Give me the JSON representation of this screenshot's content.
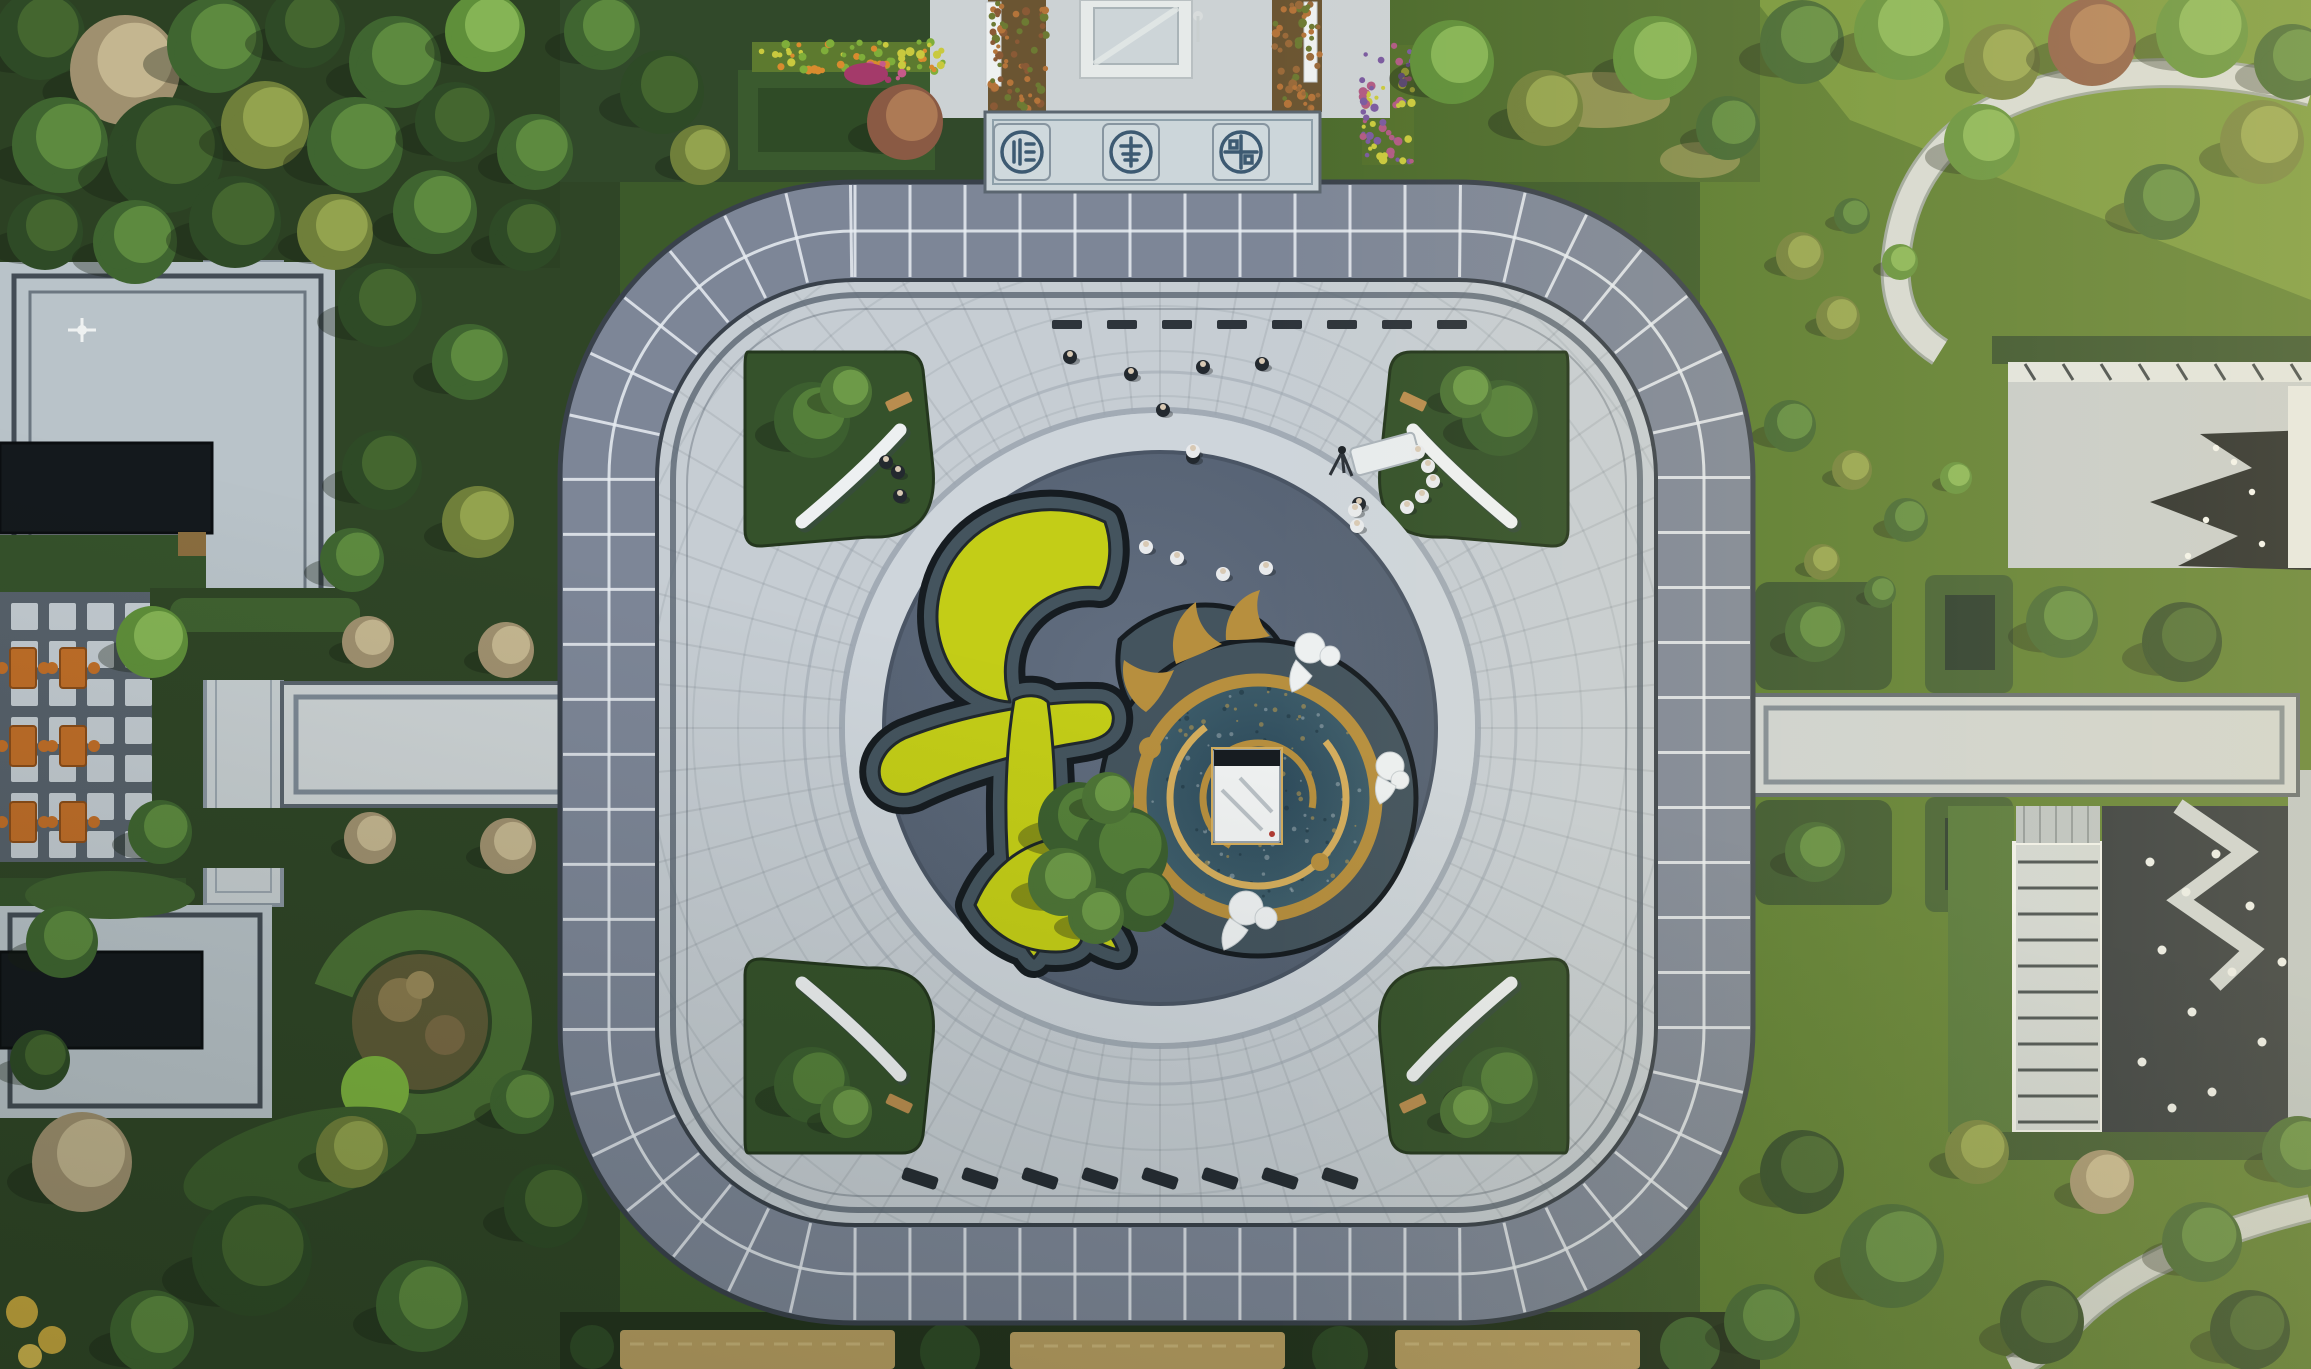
{
  "meta": {
    "title": "Aerial drone view of a landscaped residential plaza",
    "description": "Top-down aerial photograph of a square plaza ringed by a slate-tiled walkway with rounded corners. The center holds a dark circular court containing a giant chartreuse topiary of the Chinese character for harmony beside a gold-and-blue dragon-swirl water mosaic with a white stone plinth. Gardens, reflecting pools, a checkerboard terrace with orange tables, and modern courtyard buildings surround the plaza."
  },
  "palette": {
    "grass-dark": "#2f4526",
    "grass-mid": "#3c5a2a",
    "grass-bright": "#577a2e",
    "band": "#7d8697",
    "band-edge": "#39414b",
    "grout": "#e8edf2",
    "plaza": "#c6cdd3",
    "plaza-line": "#5a6572",
    "arc": "#99a3ae",
    "center-dark": "#5b6678",
    "center-rim": "#4a5565",
    "halo": "#ced5db",
    "bed-stone": "#44545e",
    "bed-dark": "#161c21",
    "chartreuse": "#c3cd17",
    "gold": "#b78f3e",
    "gold-light": "#d4ad5d",
    "mosaic1": "#2b4859",
    "mosaic2": "#4a6b75",
    "white": "#edf0f1",
    "path": "#ccd2d4",
    "path-edge": "#7c8894",
    "roof": "#b9c3c9",
    "roof-line": "#434c55",
    "pool": "#14191d",
    "hedge": "#35522b",
    "hedge-bright": "#4a7034",
    "orange": "#c06e28",
    "orange-dark": "#8a4c18",
    "cobble": "#262e38",
    "tan": "#b99f62",
    "shadow": "rgba(22,32,20,0.35)",
    "emblem": "#cfd9dd",
    "emblem-ink": "#3d5a72"
  },
  "tree_palette": {
    "deep": [
      "#2e4a26",
      "#44662f"
    ],
    "green": [
      "#3f6530",
      "#5d8a3f"
    ],
    "bright": [
      "#5f8f3a",
      "#85b455"
    ],
    "olive": [
      "#6f7f3a",
      "#93a34e"
    ],
    "rust": [
      "#8a5a44",
      "#ad7a55"
    ],
    "bare": [
      "#9f906f",
      "#c4b690"
    ],
    "pine": [
      "#3c5f2f",
      "#55803a"
    ],
    "pinehi": [
      "#4d7436",
      "#6d9a48"
    ]
  },
  "scene": {
    "emblems": [
      {
        "name": "fu-blessing-seal"
      },
      {
        "name": "shou-longevity-seal"
      },
      {
        "name": "lu-prosperity-seal"
      }
    ],
    "ring": {
      "tile_spacing": 55,
      "half_width": 46
    },
    "spokes": {
      "count": 72,
      "r1": 318,
      "r2": 668
    },
    "faint_rings": {
      "start": 332,
      "step": 45,
      "count": 8
    },
    "mosaic_speckles": {
      "cx": 1258,
      "cy": 798,
      "r": 112,
      "count": 130
    },
    "bench_row": {
      "x0": 1052,
      "y": 320,
      "step": 55,
      "count": 8,
      "w": 30,
      "h": 9
    },
    "loungers": {
      "x0": 902,
      "y": 1172,
      "step": 60,
      "count": 8,
      "w": 36,
      "h": 13,
      "angle": 18
    },
    "glass_lines": {
      "x1": 2018,
      "x2": 2098,
      "y0": 862,
      "step": 26,
      "count": 11
    },
    "roof_ticks": {
      "x0": 2025,
      "step": 38,
      "count": 8,
      "y1": 364,
      "y2": 380
    },
    "trees": [
      [
        40,
        35,
        45,
        "deep"
      ],
      [
        125,
        70,
        55,
        "bare"
      ],
      [
        215,
        45,
        48,
        "green"
      ],
      [
        305,
        28,
        40,
        "deep"
      ],
      [
        395,
        62,
        46,
        "green"
      ],
      [
        485,
        32,
        40,
        "bright"
      ],
      [
        60,
        145,
        48,
        "green"
      ],
      [
        165,
        155,
        58,
        "deep"
      ],
      [
        265,
        125,
        44,
        "olive"
      ],
      [
        355,
        145,
        48,
        "green"
      ],
      [
        455,
        122,
        40,
        "deep"
      ],
      [
        535,
        152,
        38,
        "green"
      ],
      [
        45,
        232,
        38,
        "deep"
      ],
      [
        135,
        242,
        42,
        "green"
      ],
      [
        235,
        222,
        46,
        "deep"
      ],
      [
        335,
        232,
        38,
        "olive"
      ],
      [
        435,
        212,
        42,
        "green"
      ],
      [
        525,
        235,
        36,
        "deep"
      ],
      [
        380,
        305,
        42,
        "deep"
      ],
      [
        470,
        362,
        38,
        "green"
      ],
      [
        382,
        470,
        40,
        "deep"
      ],
      [
        478,
        522,
        36,
        "olive"
      ],
      [
        352,
        560,
        32,
        "green"
      ],
      [
        152,
        642,
        36,
        "bright"
      ],
      [
        160,
        832,
        32,
        "green"
      ],
      [
        368,
        642,
        26,
        "bare"
      ],
      [
        506,
        650,
        28,
        "bare"
      ],
      [
        370,
        838,
        26,
        "bare"
      ],
      [
        508,
        846,
        28,
        "bare"
      ],
      [
        82,
        1162,
        50,
        "bare"
      ],
      [
        252,
        1256,
        60,
        "deep"
      ],
      [
        422,
        1306,
        46,
        "green"
      ],
      [
        546,
        1206,
        42,
        "deep"
      ],
      [
        152,
        1332,
        42,
        "green"
      ],
      [
        352,
        1152,
        36,
        "olive"
      ],
      [
        522,
        1102,
        32,
        "green"
      ],
      [
        62,
        942,
        36,
        "green"
      ],
      [
        40,
        1060,
        30,
        "deep"
      ],
      [
        602,
        32,
        38,
        "green"
      ],
      [
        662,
        92,
        42,
        "deep"
      ],
      [
        905,
        122,
        38,
        "rust"
      ],
      [
        700,
        155,
        30,
        "olive"
      ],
      [
        1452,
        62,
        42,
        "bright"
      ],
      [
        1545,
        108,
        38,
        "olive"
      ],
      [
        1655,
        58,
        42,
        "bright"
      ],
      [
        1728,
        128,
        32,
        "green"
      ],
      [
        1802,
        42,
        42,
        "green"
      ],
      [
        1902,
        32,
        48,
        "bright"
      ],
      [
        2002,
        62,
        38,
        "olive"
      ],
      [
        2092,
        42,
        44,
        "rust"
      ],
      [
        2202,
        32,
        46,
        "bright"
      ],
      [
        2292,
        62,
        38,
        "green"
      ],
      [
        1982,
        142,
        38,
        "bright"
      ],
      [
        2262,
        142,
        42,
        "olive"
      ],
      [
        2162,
        202,
        38,
        "green"
      ],
      [
        1800,
        256,
        24,
        "olive"
      ],
      [
        1852,
        216,
        18,
        "green"
      ],
      [
        1900,
        262,
        18,
        "bright"
      ],
      [
        1838,
        318,
        22,
        "olive"
      ],
      [
        1790,
        426,
        26,
        "green"
      ],
      [
        1852,
        470,
        20,
        "olive"
      ],
      [
        1906,
        520,
        22,
        "green"
      ],
      [
        1956,
        478,
        16,
        "bright"
      ],
      [
        1822,
        562,
        18,
        "olive"
      ],
      [
        1880,
        592,
        16,
        "green"
      ],
      [
        2062,
        622,
        36,
        "green"
      ],
      [
        2182,
        642,
        40,
        "deep"
      ],
      [
        1815,
        632,
        30,
        "green"
      ],
      [
        1815,
        852,
        30,
        "green"
      ],
      [
        1802,
        1172,
        42,
        "deep"
      ],
      [
        1892,
        1256,
        52,
        "green"
      ],
      [
        2042,
        1322,
        42,
        "deep"
      ],
      [
        2202,
        1242,
        40,
        "green"
      ],
      [
        1977,
        1152,
        32,
        "olive"
      ],
      [
        2298,
        1152,
        36,
        "green"
      ],
      [
        2102,
        1182,
        32,
        "bare"
      ],
      [
        1762,
        1322,
        38,
        "green"
      ],
      [
        2250,
        1330,
        40,
        "deep"
      ]
    ],
    "plaza_trees": [
      [
        812,
        420,
        38,
        "pine"
      ],
      [
        846,
        392,
        26,
        "pinehi"
      ],
      [
        1500,
        418,
        38,
        "pine"
      ],
      [
        1466,
        392,
        26,
        "pinehi"
      ],
      [
        812,
        1085,
        38,
        "pine"
      ],
      [
        846,
        1112,
        26,
        "pinehi"
      ],
      [
        1500,
        1085,
        38,
        "pine"
      ],
      [
        1466,
        1112,
        26,
        "pinehi"
      ],
      [
        1078,
        822,
        40,
        "pine"
      ],
      [
        1122,
        852,
        46,
        "pine"
      ],
      [
        1062,
        882,
        34,
        "pinehi"
      ],
      [
        1142,
        900,
        32,
        "pine"
      ],
      [
        1096,
        916,
        28,
        "pinehi"
      ],
      [
        1108,
        798,
        26,
        "pinehi"
      ]
    ],
    "people": [
      [
        1070,
        357,
        "dark"
      ],
      [
        1131,
        374,
        "dark"
      ],
      [
        1203,
        367,
        "dark"
      ],
      [
        1262,
        364,
        "dark"
      ],
      [
        1163,
        410,
        "dark"
      ],
      [
        1193,
        457,
        "dark"
      ],
      [
        898,
        472,
        "dark"
      ],
      [
        900,
        496,
        "dark"
      ],
      [
        886,
        462,
        "dark"
      ],
      [
        1359,
        504,
        "dark"
      ],
      [
        1146,
        547,
        "light"
      ],
      [
        1177,
        558,
        "light"
      ],
      [
        1223,
        574,
        "light"
      ],
      [
        1266,
        568,
        "light"
      ],
      [
        1193,
        451,
        "light"
      ],
      [
        1355,
        510,
        "light"
      ],
      [
        1357,
        526,
        "light"
      ],
      [
        1418,
        452,
        "light"
      ],
      [
        1428,
        466,
        "light"
      ],
      [
        1433,
        481,
        "light"
      ],
      [
        1422,
        496,
        "light"
      ],
      [
        1407,
        507,
        "light"
      ]
    ],
    "rocks": [
      [
        2150,
        862
      ],
      [
        2186,
        892
      ],
      [
        2216,
        854
      ],
      [
        2250,
        906
      ],
      [
        2162,
        950
      ],
      [
        2232,
        972
      ],
      [
        2192,
        1012
      ],
      [
        2262,
        1042
      ],
      [
        2142,
        1062
      ],
      [
        2212,
        1092
      ],
      [
        2282,
        962
      ],
      [
        2172,
        1108
      ]
    ],
    "pool_lights": [
      [
        2216,
        448
      ],
      [
        2252,
        492
      ],
      [
        2206,
        520
      ],
      [
        2262,
        544
      ],
      [
        2292,
        458
      ],
      [
        2298,
        522
      ],
      [
        2188,
        556
      ],
      [
        2234,
        462
      ]
    ],
    "flower_strips": [
      {
        "x": 752,
        "y": 42,
        "w": 198,
        "h": 30,
        "colors": [
          "#c9c93e",
          "#d98b2e",
          "#7fae3a"
        ]
      },
      {
        "x": 862,
        "y": 62,
        "w": 44,
        "h": 24,
        "colors": [
          "#a43a6a",
          "#c75a8a"
        ]
      },
      {
        "x": 1362,
        "y": 45,
        "w": 52,
        "h": 120,
        "colors": [
          "#7a5aa0",
          "#c9c93e",
          "#b05a84"
        ]
      },
      {
        "x": 990,
        "y": 2,
        "w": 56,
        "h": 108,
        "colors": [
          "#b4743a",
          "#8a5a36",
          "#6d7a33"
        ]
      },
      {
        "x": 1274,
        "y": 2,
        "w": 46,
        "h": 108,
        "colors": [
          "#b4743a",
          "#9a6a3a",
          "#6d7a33"
        ]
      }
    ],
    "counts": {
      "people_visible": 22,
      "corner_planters": 4,
      "seal_medallions": 3
    }
  }
}
